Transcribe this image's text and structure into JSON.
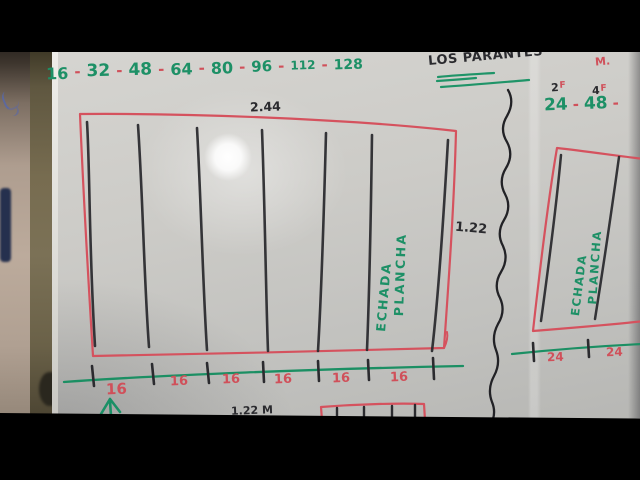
{
  "photo": {
    "top_sequence": {
      "separator": "-",
      "values": [
        "16",
        "32",
        "48",
        "64",
        "80",
        "96",
        "112",
        "128"
      ]
    },
    "header": {
      "title": "LOS PARANTES",
      "unit_label": "M."
    },
    "right_panel": {
      "sup_labels": [
        {
          "base": "2",
          "sup": "F"
        },
        {
          "base": "4",
          "sup": "F"
        }
      ],
      "sequence": {
        "separator": "-",
        "values": [
          "24",
          "48"
        ],
        "trailing_separator": "-"
      }
    },
    "main_box": {
      "top_dimension": "2.44",
      "side_dimension": "1.22",
      "label_line1": "PLANCHA",
      "label_line2": "ECHADA"
    },
    "right_box": {
      "label_line1": "PLANCHA",
      "label_line2": "ECHADA"
    },
    "main_ruler": {
      "segment_labels": [
        "16",
        "16",
        "16",
        "16",
        "16",
        "16"
      ]
    },
    "right_ruler": {
      "segment_labels": [
        "24",
        "24"
      ]
    },
    "bottom_partial_label": "1.22 M",
    "colors": {
      "marker_green": "#1d9066",
      "marker_red": "#d0505a",
      "marker_black": "#2a2a2e",
      "board_gray": "#c8c7c3"
    }
  }
}
